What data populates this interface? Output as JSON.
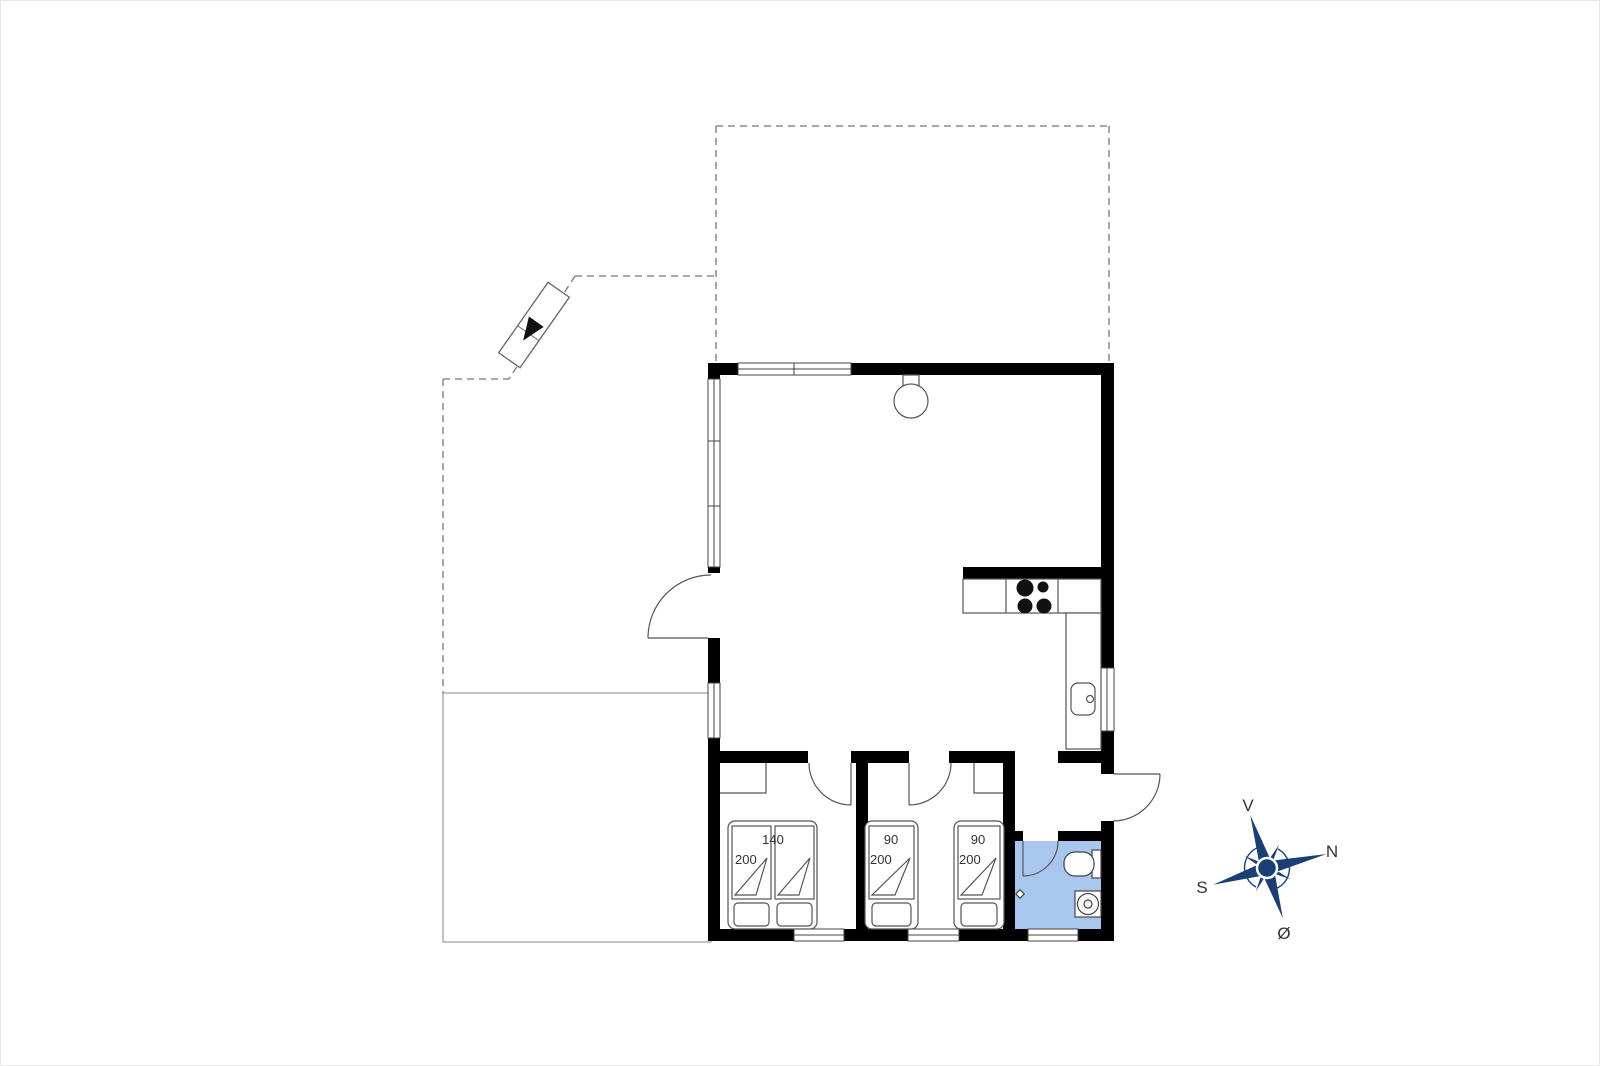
{
  "floorplan": {
    "beds": [
      {
        "width_label": "140",
        "length_label": "200"
      },
      {
        "width_label": "90",
        "length_label": "200"
      },
      {
        "width_label": "90",
        "length_label": "200"
      }
    ],
    "compass": {
      "top": "V",
      "right": "N",
      "left": "S",
      "bottom": "Ø"
    },
    "colors": {
      "wall": "#000000",
      "bathroom_floor": "#a9c7ee",
      "compass_navy": "#1b3e75",
      "furniture_line": "#555555",
      "dashed_line": "#777777",
      "terrace_line": "#9a9a9a",
      "label_text": "#333333"
    }
  }
}
